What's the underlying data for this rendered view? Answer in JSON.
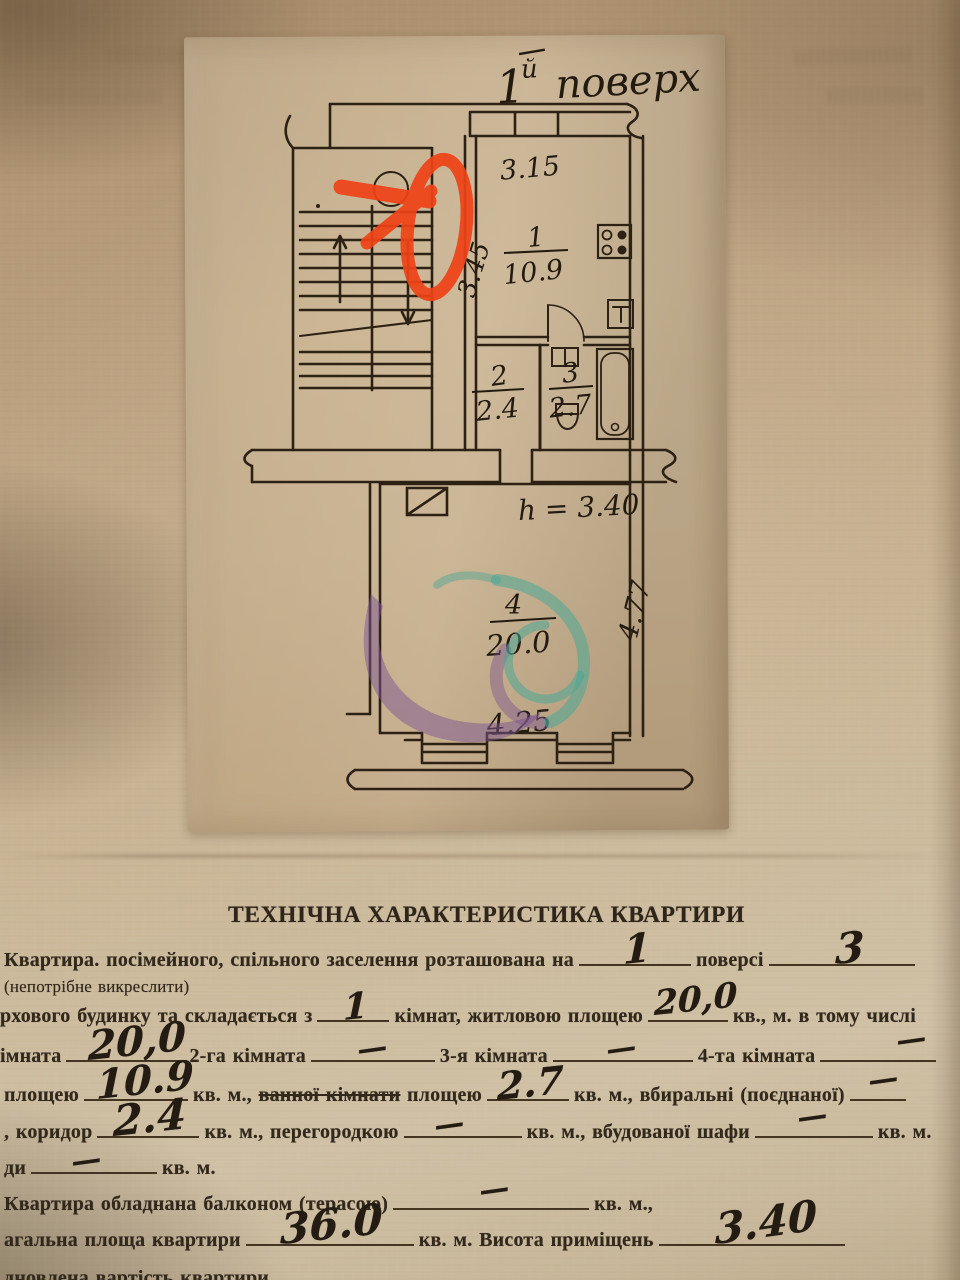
{
  "plan": {
    "title": {
      "num": "1",
      "sup": "й",
      "word": "поверх"
    },
    "labels": {
      "dim_width_kitchen": "3.15",
      "dim_depth_kitchen": "3.45",
      "room1_num": "1",
      "room1_area": "10.9",
      "room2_num": "2",
      "room2_area": "2.4",
      "room3_num": "3",
      "room3_area": "2.7",
      "room4_num": "4",
      "room4_area": "20.0",
      "height_note": "h = 3.40",
      "dim_depth_room4": "4.77",
      "dim_width_room4": "4.25"
    },
    "annotation_color": "#ef4318",
    "watermark_purple": "#7c5591",
    "watermark_teal": "#4aa795"
  },
  "form": {
    "title": "ТЕХНІЧНА ХАРАКТЕРИСТИКА КВАРТИРИ",
    "line1": {
      "t1": "Квартира. посімейного, спільного заселення розташована на",
      "v1": "1",
      "t2": "поверсі",
      "v2": "3"
    },
    "note": "(непотрібне викреслити)",
    "line2": {
      "t1": "рхового будинку та складається з",
      "v1": "1",
      "t2": "кімнат, житловою площею",
      "v2": "20,0",
      "t3": "кв., м. в тому числі"
    },
    "line3": {
      "t1": "імната",
      "v1": "20,0",
      "t2": "2-га кімната",
      "v2": "—",
      "t3": "3-я кімната",
      "v3": "—",
      "t4": "4-та кімната",
      "v4": "—"
    },
    "line4": {
      "t1": "площею",
      "v1": "10.9",
      "t2": "кв. м.,",
      "struck": "ванної кімнати",
      "t3": "площею",
      "v2": "2.7",
      "t4": "кв. м., вбиральні  (поєднаної)",
      "v3": "—"
    },
    "line5": {
      "t1": ", коридор",
      "v1": "2.4",
      "t2": "кв. м., перегородкою",
      "v2": "—",
      "t3": "кв. м., вбудованої  шафи",
      "v3": "—",
      "t4": "кв. м."
    },
    "line6": {
      "t1": "ди",
      "v1": "—",
      "t2": "кв. м."
    },
    "line7": {
      "t1": "Квартира обладнана балконом (терасою)",
      "v1": "—",
      "t2": "кв. м.,"
    },
    "line8": {
      "t1": "агальна площа квартири",
      "v1": "36.0",
      "t2": "кв. м. Висота приміщень",
      "v2": "3.40"
    },
    "line9": {
      "t1": "дновлена вартість квартири"
    }
  }
}
